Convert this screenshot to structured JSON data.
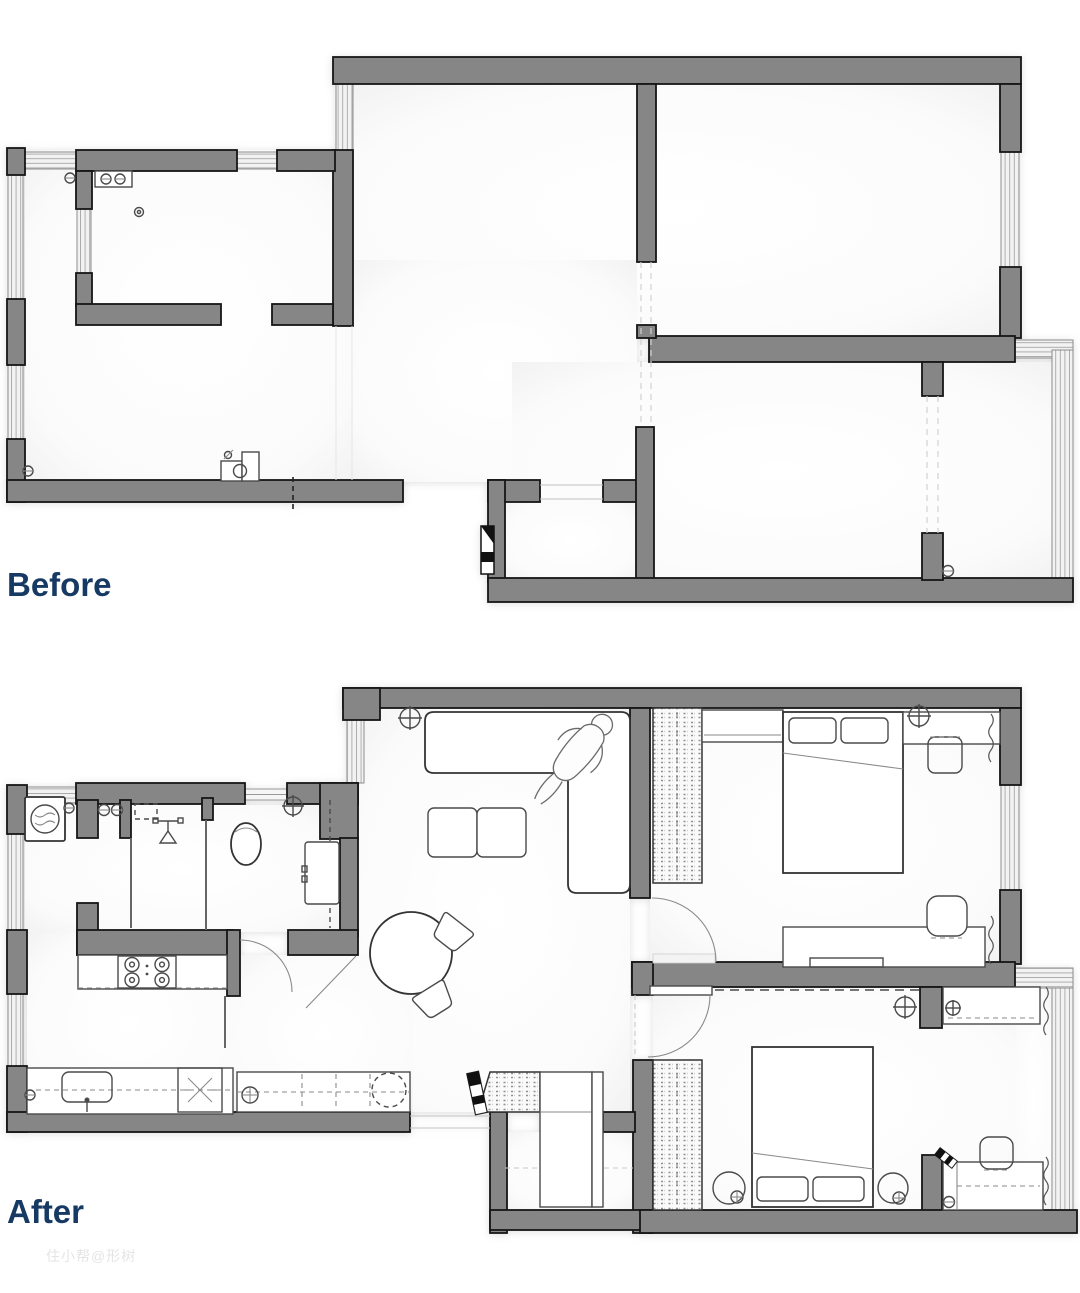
{
  "canvas": {
    "width": 1080,
    "height": 1293,
    "background": "#ffffff"
  },
  "labels": {
    "before": "Before",
    "after": "After"
  },
  "watermark": {
    "text": "住小帮@形树"
  },
  "colors": {
    "wall_fill": "#868686",
    "wall_stroke": "#161616",
    "label_text": "#173a64",
    "watermark_text": "#e4e4e4",
    "window_fill": "#f2f2f2",
    "window_line": "#a8a8a8",
    "furniture_stroke": "#4a4a4a",
    "floor": "#fdfdfd",
    "guide_dash": "#c9c9c9"
  },
  "plans": {
    "before": {
      "label": "Before",
      "style": "empty shell floor plan",
      "rooms": [
        "kitchen",
        "living-dining",
        "bedroom-large",
        "bedroom-small",
        "entry-hall"
      ],
      "symbols": [
        "double-sink",
        "gas-meter",
        "toilet",
        "radiator-valves",
        "entry-door-marker",
        "window-bands",
        "removed-wall-dashes"
      ]
    },
    "after": {
      "label": "After",
      "style": "furnished floor plan",
      "rooms": [
        "laundry-nook",
        "shower-room",
        "wc",
        "vanity-room",
        "kitchen",
        "living-dining",
        "hallway",
        "entry",
        "bedroom-1",
        "bedroom-2",
        "balcony"
      ],
      "furniture": [
        "washing-machine",
        "shower-head",
        "toilet",
        "vanity-cabinet",
        "cooktop-4-burner",
        "kitchen-sink",
        "water-heater",
        "hall-closets",
        "entry-wardrobe",
        "l-shaped-sofa",
        "person-figure",
        "coffee-tables",
        "round-dining-table",
        "dining-chairs",
        "wardrobes",
        "double-bed-1",
        "double-bed-2",
        "desks",
        "desk-chairs",
        "nightstands",
        "round-nightstands",
        "curtains",
        "ceiling-lights",
        "door-swings"
      ]
    }
  }
}
